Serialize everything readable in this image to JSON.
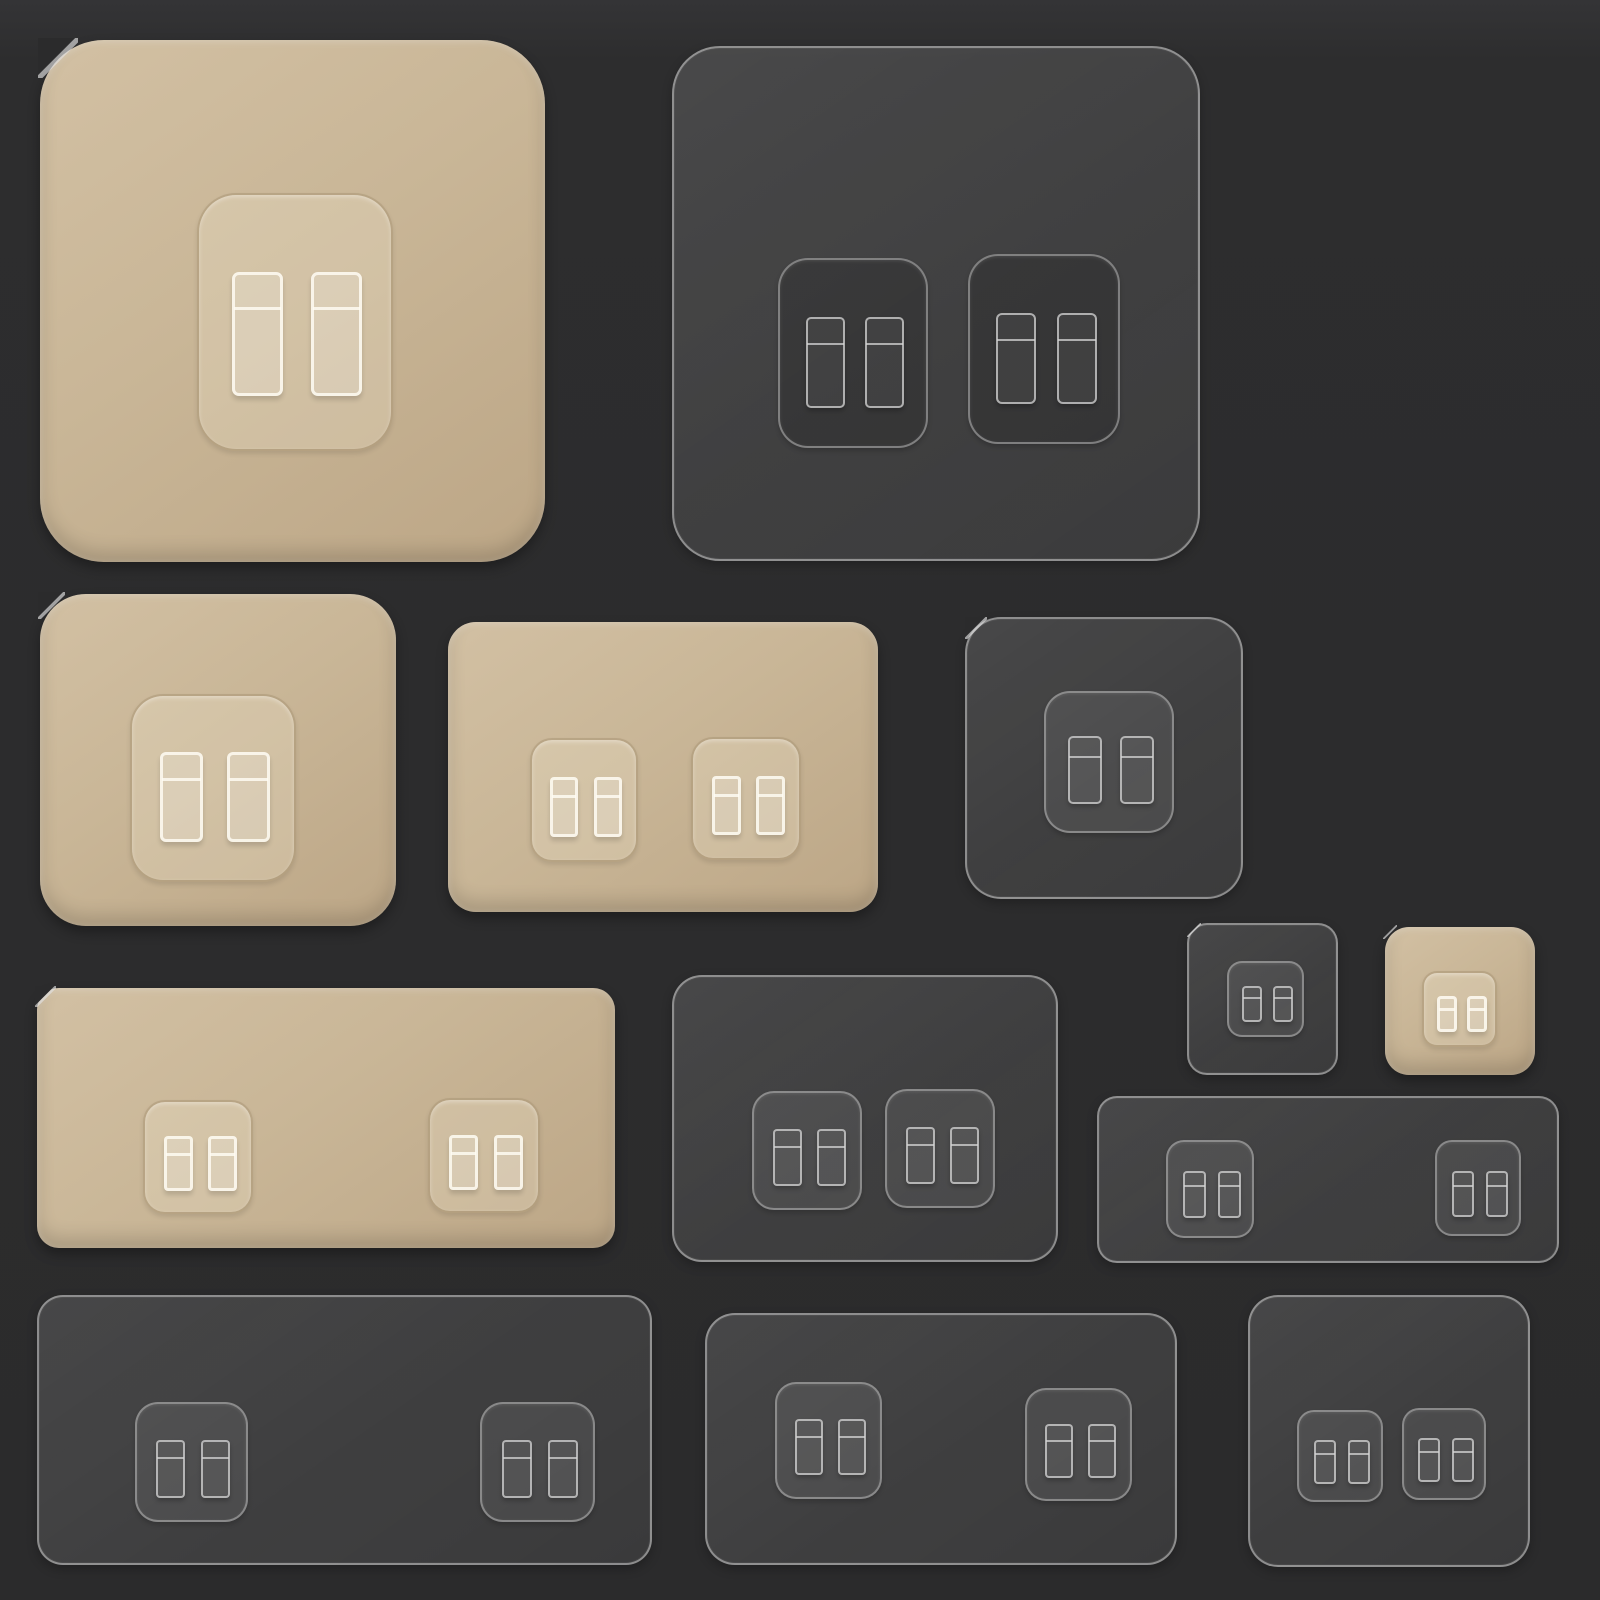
{
  "scene": {
    "alt": "Product photo: assorted double-sided adhesive wall-hook mounting pads on a dark background",
    "background_color": "#2b2b2c",
    "beige_pad_color": "#c9b697",
    "clear_pad_edge_color": "#d0d0d0"
  },
  "pads": [
    {
      "id": "xl-beige",
      "type": "beige",
      "x": 40,
      "y": 40,
      "w": 505,
      "h": 522,
      "r": 64,
      "notch": true,
      "mounts": [
        {
          "dx": 157,
          "dy": 153,
          "w": 196,
          "h": 258,
          "shade": "light"
        }
      ]
    },
    {
      "id": "xl-clear",
      "type": "clear",
      "x": 672,
      "y": 46,
      "w": 528,
      "h": 515,
      "r": 48,
      "notch": false,
      "mounts": [
        {
          "dx": 104,
          "dy": 210,
          "w": 150,
          "h": 190,
          "shade": "dark"
        },
        {
          "dx": 294,
          "dy": 206,
          "w": 152,
          "h": 190,
          "shade": "dark"
        }
      ]
    },
    {
      "id": "md-beige",
      "type": "beige",
      "x": 40,
      "y": 594,
      "w": 356,
      "h": 332,
      "r": 46,
      "notch": true,
      "mounts": [
        {
          "dx": 90,
          "dy": 100,
          "w": 166,
          "h": 188,
          "shade": "light"
        }
      ]
    },
    {
      "id": "wide-beige-md",
      "type": "beige",
      "x": 448,
      "y": 622,
      "w": 430,
      "h": 290,
      "r": 28,
      "notch": false,
      "mounts": [
        {
          "dx": 82,
          "dy": 116,
          "w": 108,
          "h": 124,
          "shade": "light"
        },
        {
          "dx": 243,
          "dy": 115,
          "w": 110,
          "h": 123,
          "shade": "light"
        }
      ]
    },
    {
      "id": "md-clear",
      "type": "clear",
      "x": 965,
      "y": 617,
      "w": 278,
      "h": 282,
      "r": 36,
      "notch": true,
      "mounts": [
        {
          "dx": 77,
          "dy": 72,
          "w": 130,
          "h": 142,
          "shade": "light"
        }
      ]
    },
    {
      "id": "sm-clear",
      "type": "clear",
      "x": 1187,
      "y": 923,
      "w": 151,
      "h": 152,
      "r": 20,
      "notch": true,
      "mounts": [
        {
          "dx": 38,
          "dy": 36,
          "w": 77,
          "h": 76,
          "shade": "light"
        }
      ]
    },
    {
      "id": "sm-beige",
      "type": "beige",
      "x": 1385,
      "y": 927,
      "w": 150,
      "h": 148,
      "r": 24,
      "notch": true,
      "mounts": [
        {
          "dx": 37,
          "dy": 44,
          "w": 75,
          "h": 76,
          "shade": "light"
        }
      ]
    },
    {
      "id": "wide-beige-lg",
      "type": "beige",
      "x": 37,
      "y": 988,
      "w": 578,
      "h": 260,
      "r": 22,
      "notch": true,
      "mounts": [
        {
          "dx": 106,
          "dy": 112,
          "w": 110,
          "h": 114,
          "shade": "light"
        },
        {
          "dx": 391,
          "dy": 110,
          "w": 112,
          "h": 115,
          "shade": "light"
        }
      ]
    },
    {
      "id": "md-clear-2",
      "type": "clear",
      "x": 672,
      "y": 975,
      "w": 386,
      "h": 287,
      "r": 30,
      "notch": false,
      "mounts": [
        {
          "dx": 78,
          "dy": 114,
          "w": 110,
          "h": 119,
          "shade": "light"
        },
        {
          "dx": 211,
          "dy": 112,
          "w": 110,
          "h": 119,
          "shade": "light"
        }
      ]
    },
    {
      "id": "strip-clear",
      "type": "clear",
      "x": 1097,
      "y": 1096,
      "w": 462,
      "h": 167,
      "r": 20,
      "notch": false,
      "mounts": [
        {
          "dx": 67,
          "dy": 42,
          "w": 88,
          "h": 98,
          "shade": "light"
        },
        {
          "dx": 336,
          "dy": 42,
          "w": 86,
          "h": 96,
          "shade": "light"
        }
      ]
    },
    {
      "id": "wide-clear",
      "type": "clear",
      "x": 37,
      "y": 1295,
      "w": 615,
      "h": 270,
      "r": 26,
      "notch": false,
      "mounts": [
        {
          "dx": 96,
          "dy": 105,
          "w": 113,
          "h": 120,
          "shade": "light"
        },
        {
          "dx": 441,
          "dy": 105,
          "w": 115,
          "h": 120,
          "shade": "light"
        }
      ]
    },
    {
      "id": "md-clear-3",
      "type": "clear",
      "x": 705,
      "y": 1313,
      "w": 472,
      "h": 252,
      "r": 30,
      "notch": false,
      "mounts": [
        {
          "dx": 68,
          "dy": 67,
          "w": 107,
          "h": 117,
          "shade": "light"
        },
        {
          "dx": 318,
          "dy": 73,
          "w": 107,
          "h": 113,
          "shade": "light"
        }
      ]
    },
    {
      "id": "md-clear-4",
      "type": "clear",
      "x": 1248,
      "y": 1295,
      "w": 282,
      "h": 272,
      "r": 30,
      "notch": false,
      "mounts": [
        {
          "dx": 47,
          "dy": 113,
          "w": 86,
          "h": 92,
          "shade": "light"
        },
        {
          "dx": 152,
          "dy": 111,
          "w": 84,
          "h": 92,
          "shade": "light"
        }
      ]
    }
  ]
}
